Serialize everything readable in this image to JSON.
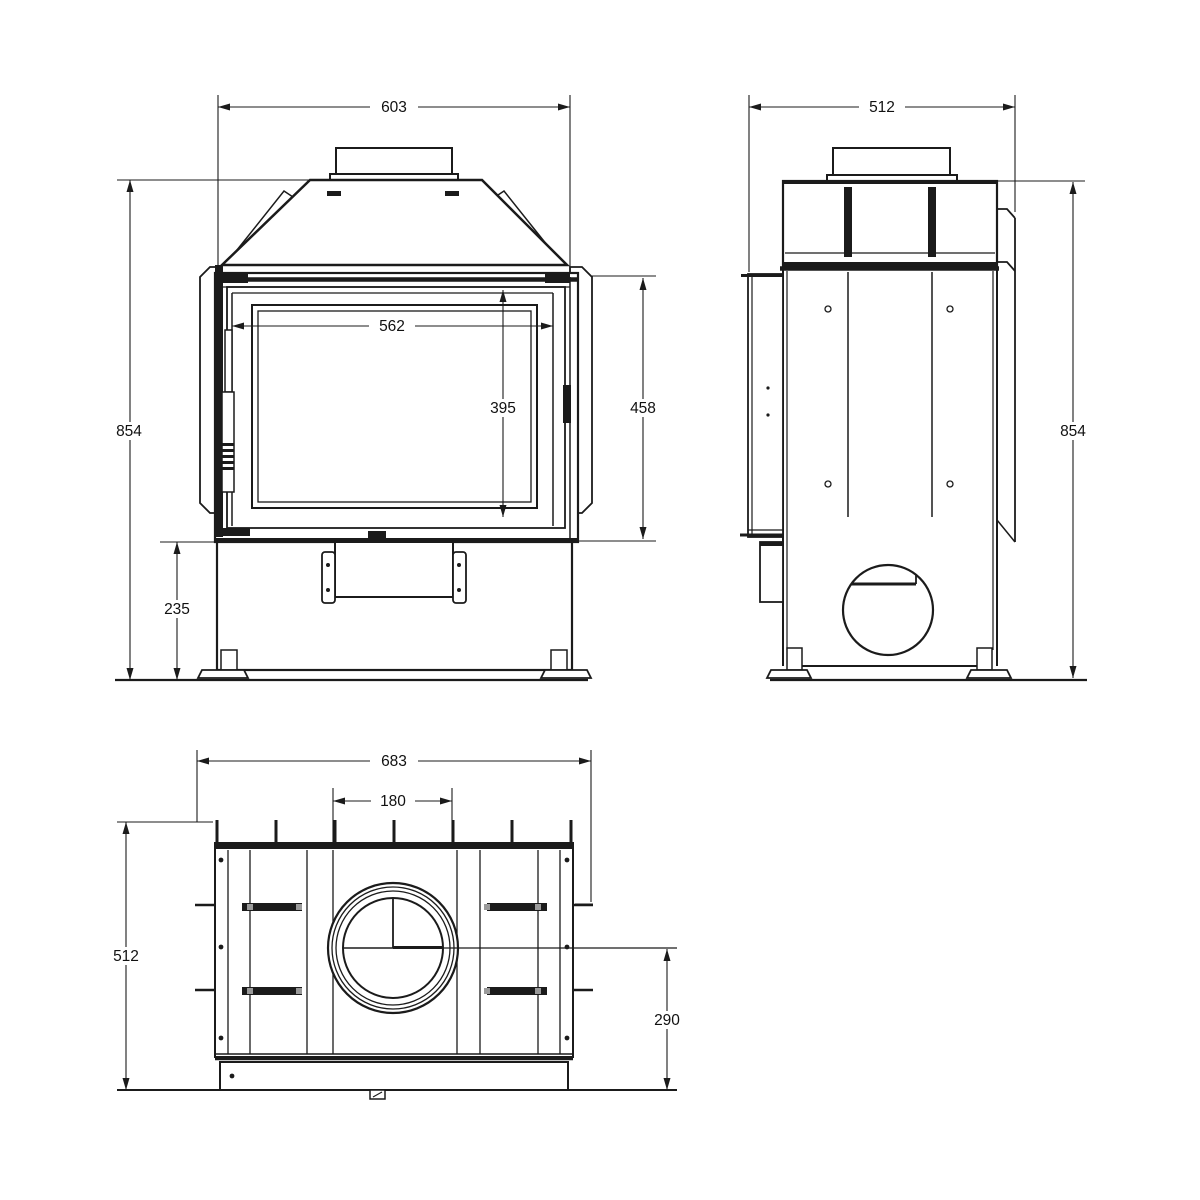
{
  "palette": {
    "background": "#ffffff",
    "ink": "#1b1b1b"
  },
  "drawing": {
    "views": {
      "front": {
        "dims": {
          "overall_width": "603",
          "overall_height": "854",
          "opening_width": "562",
          "opening_height": "395",
          "door_height": "458",
          "base_height": "235"
        }
      },
      "side": {
        "dims": {
          "overall_depth": "512",
          "overall_height": "854"
        }
      },
      "top": {
        "dims": {
          "overall_width": "683",
          "flue_diameter": "180",
          "overall_depth": "512",
          "flue_center_to_front": "290"
        }
      }
    }
  }
}
